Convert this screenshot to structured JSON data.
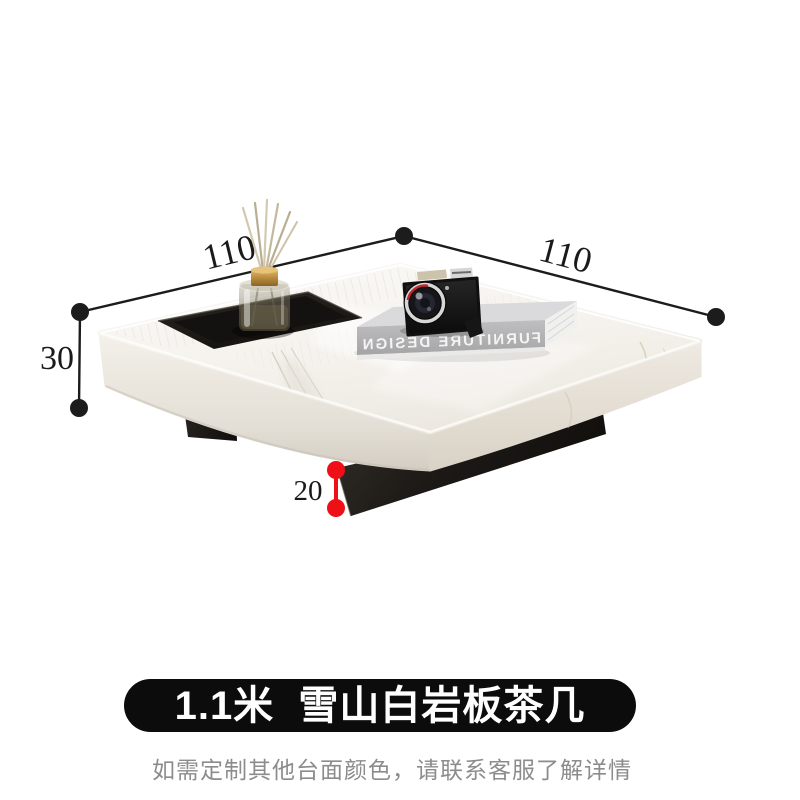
{
  "dimensions": {
    "width_left": "110",
    "width_right": "110",
    "height_top": "30",
    "height_base": "20"
  },
  "decor": {
    "book_spine_title": "FURNITURE DESIGN"
  },
  "banner": {
    "title": "1.1米  雪山白岩板茶几"
  },
  "note": {
    "text": "如需定制其他台面颜色，请联系客服了解详情"
  },
  "colors": {
    "dimension_ink": "#1c1c1c",
    "accent_red": "#ee1016",
    "banner_bg": "#0c0c0c",
    "banner_text": "#ffffff",
    "note_text": "#8c8c8c",
    "tabletop_white": "#f5f2ee",
    "base_black": "#1b1814",
    "tray_black": "#1d1b18",
    "gold_cap": "#c49a4a"
  }
}
